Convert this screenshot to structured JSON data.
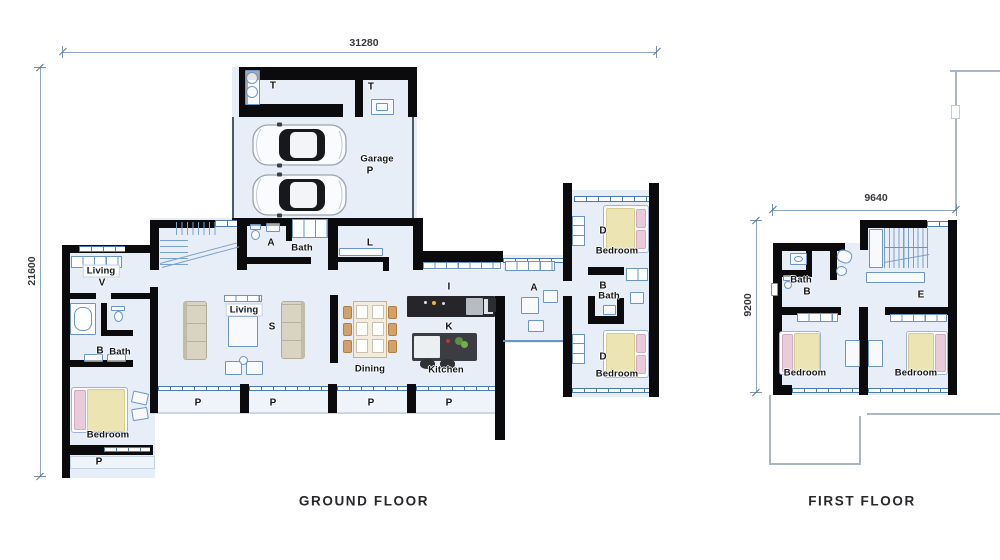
{
  "ground_floor": {
    "title": "GROUND FLOOR",
    "dims": {
      "width": "31280",
      "height": "21600"
    },
    "labels": {
      "t": "T",
      "garage": "Garage",
      "p": "P",
      "a": "A",
      "bath": "Bath",
      "l": "L",
      "living": "Living",
      "v": "V",
      "b": "B",
      "s": "S",
      "i": "I",
      "k": "K",
      "d": "D",
      "bedroom": "Bedroom",
      "dining": "Dining",
      "kitchen": "Kitchen"
    }
  },
  "first_floor": {
    "title": "FIRST FLOOR",
    "dims": {
      "width": "9640",
      "height": "9200"
    },
    "labels": {
      "bath": "Bath",
      "b": "B",
      "e": "E",
      "bedroom": "Bedroom"
    }
  },
  "colors": {
    "wall": "#0b0b0d",
    "floor": "#e8eef8",
    "porch_floor": "#eff4fb",
    "blue_line": "#6b95c6",
    "window_frame": "#4a7cb0",
    "dimension_line": "#8ba6c6",
    "bed_duvet_yellow": "#ece5b3",
    "bed_pillow_pink": "#e9cbdb",
    "sofa_beige": "#d9d3c3",
    "chair_tan": "#d2a069",
    "kitchen_counter_dark": "#26262a",
    "car_glass": "#16181c"
  }
}
